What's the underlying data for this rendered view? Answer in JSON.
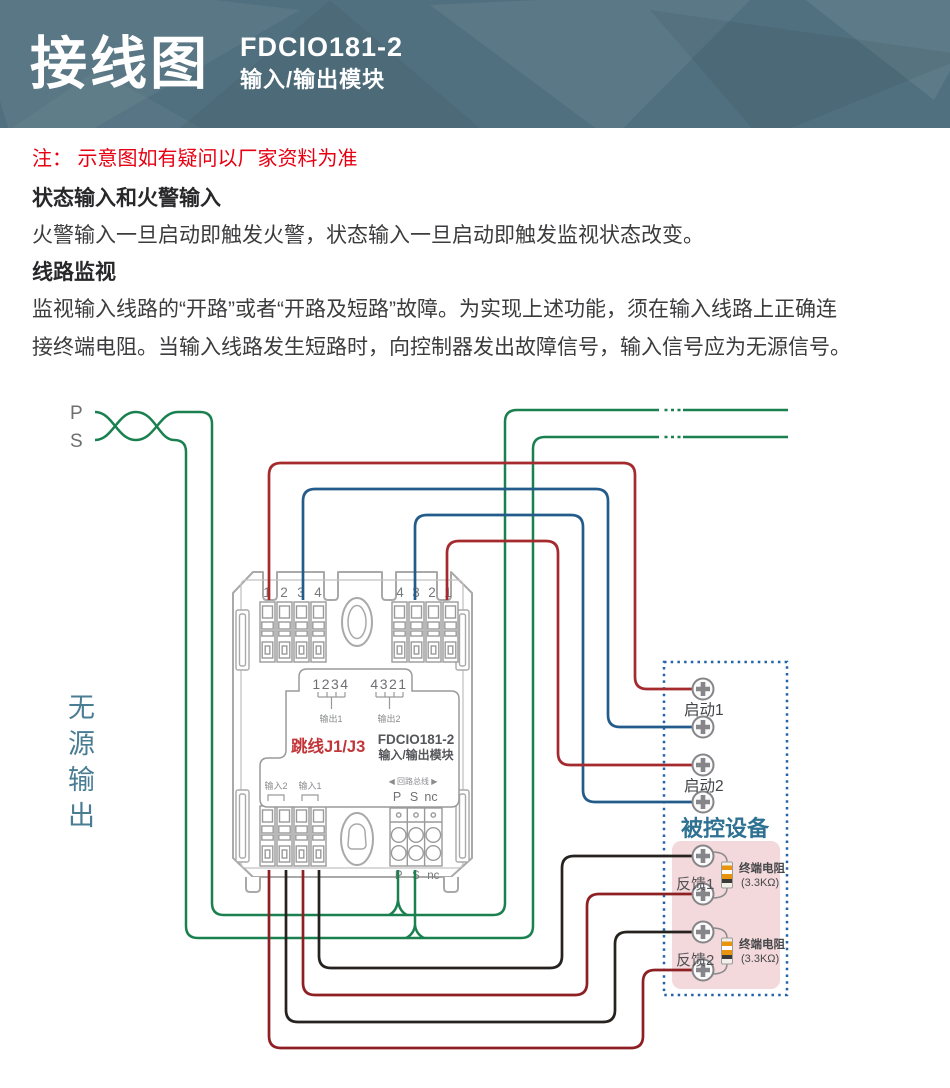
{
  "header": {
    "title": "接线图",
    "model": "FDCIO181-2",
    "subtitle": "输入/输出模块"
  },
  "note": "注：  示意图如有疑问以厂家资料为准",
  "sections": [
    {
      "heading": "状态输入和火警输入",
      "body": "火警输入一旦启动即触发火警，状态输入一旦启动即触发监视状态改变。"
    },
    {
      "heading": "线路监视",
      "body": "监视输入线路的“开路”或者“开路及短路”故障。为实现上述功能，须在输入线路上正确连接终端电阻。当输入线路发生短路时，向控制器发出故障信号，输入信号应为无源信号。"
    }
  ],
  "diagram": {
    "loop_in": {
      "p": "P",
      "s": "S"
    },
    "passive_output": "无源输出",
    "module": {
      "top_left_nums": [
        "1",
        "2",
        "3",
        "4"
      ],
      "top_right_nums": [
        "4",
        "3",
        "2",
        "1"
      ],
      "out1_pins": "1234",
      "out2_pins": "4321",
      "out1": "输出1",
      "out2": "输出2",
      "jumper": "跳线J1/J3",
      "model": "FDCIO181-2",
      "model_sub": "输入/输出模块",
      "in2": "输入2",
      "in1": "输入1",
      "loop_bus": "◀ 回路总线 ▶",
      "bus": [
        "P",
        "S",
        "nc"
      ]
    },
    "device": {
      "title": "被控设备",
      "start1": "启动1",
      "start2": "启动2",
      "feedback1": "反馈1",
      "feedback2": "反馈2",
      "resistor": "终端电阻",
      "resistor_value": "(3.3KΩ)"
    },
    "colors": {
      "header_bg": "#51707f",
      "note_red": "#e60012",
      "loop_green": "#1a8050",
      "wire_red": "#a52a2e",
      "wire_blue": "#235c8a",
      "wire_black": "#26221f",
      "wire_dark_red": "#8e2024",
      "dashed_box_blue": "#2563a8",
      "panel_pink": "#f3d9db",
      "device_title_blue": "#2e7193",
      "passive_text_blue": "#4a7d94"
    }
  }
}
